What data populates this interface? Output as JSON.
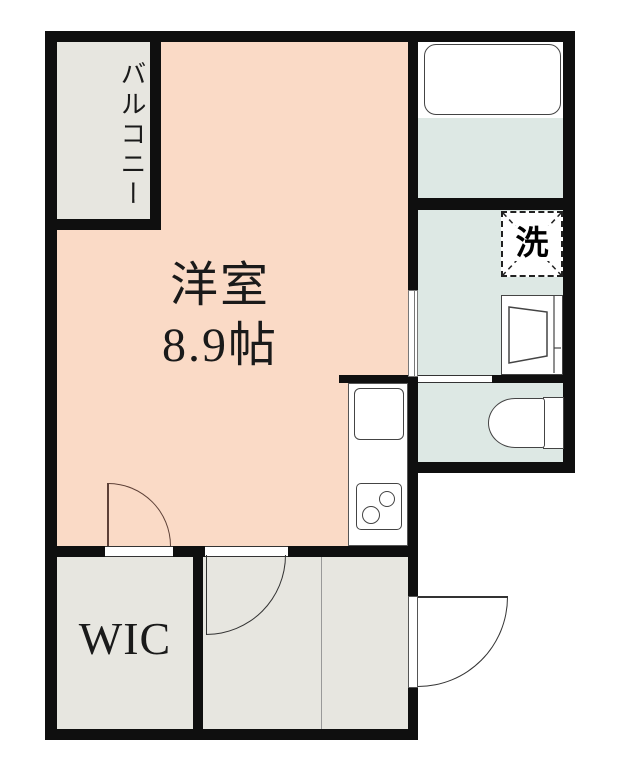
{
  "floorplan": {
    "labels": {
      "balcony": "バルコニー",
      "room_name": "洋室",
      "room_size": "8.9帖",
      "wic": "WIC",
      "washer": "洗"
    },
    "colors": {
      "wall": "#0f0f0f",
      "room_fill": "#fadac6",
      "wet_area_fill": "#dde8e4",
      "gray_area_fill": "#e7e6e0",
      "fixture_fill": "#ffffff",
      "line": "#444444",
      "door_arc": "#5d4037",
      "background": "#ffffff"
    }
  }
}
